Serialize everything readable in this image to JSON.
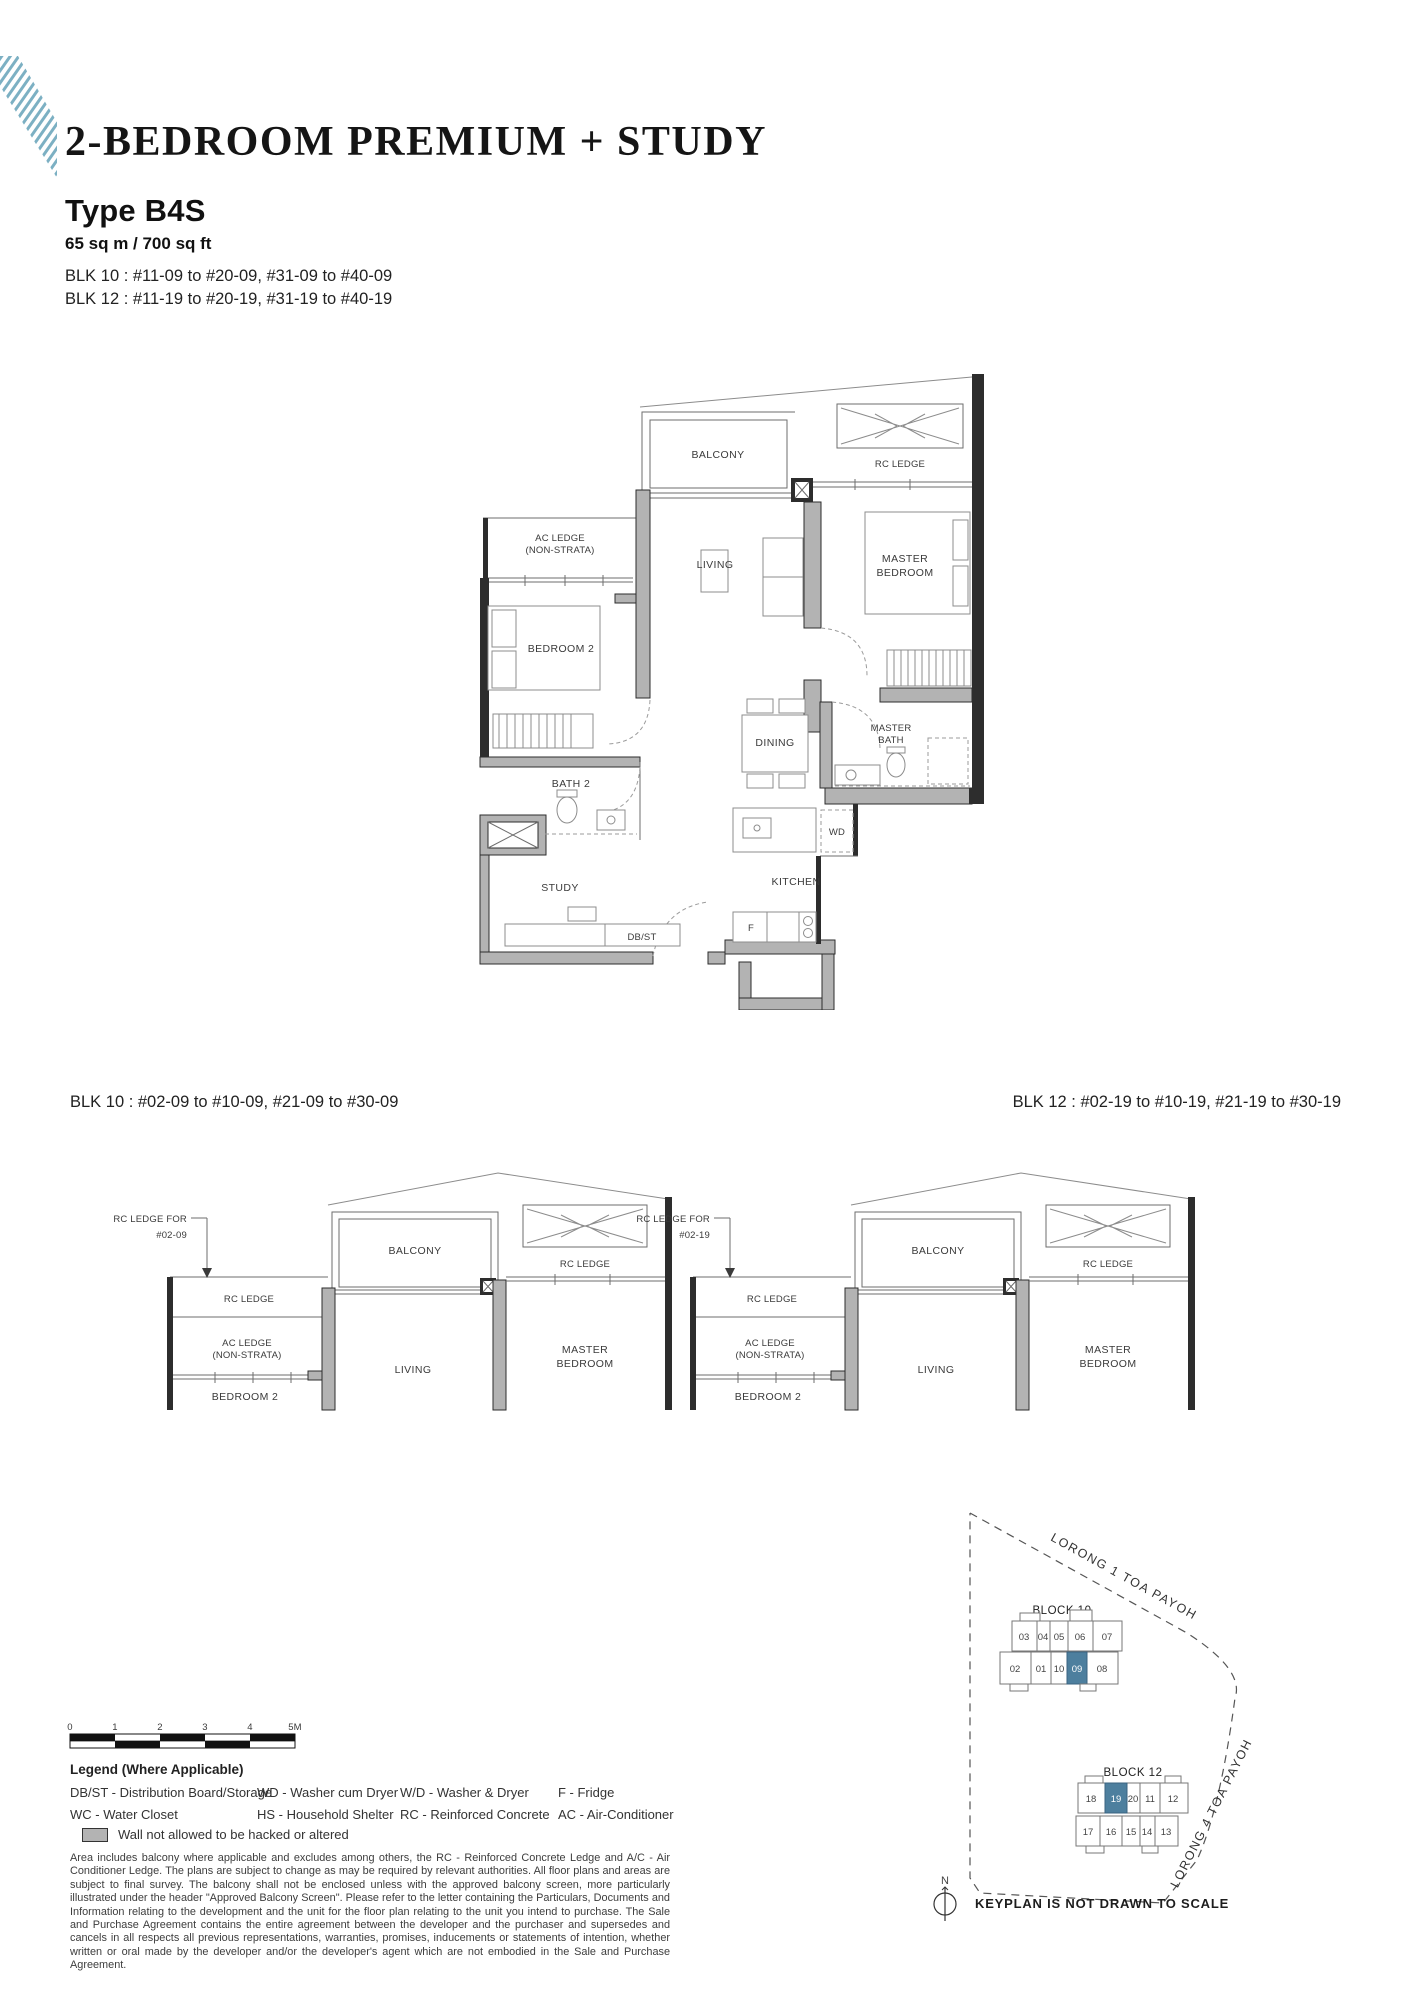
{
  "header": {
    "title": "2-BEDROOM PREMIUM + STUDY",
    "type_label": "Type B4S",
    "area": "65 sq m / 700 sq ft",
    "blk_line1": "BLK 10 : #11-09 to #20-09, #31-09 to #40-09",
    "blk_line2": "BLK 12 : #11-19 to #20-19, #31-19 to #40-19"
  },
  "main_plan": {
    "balcony": "BALCONY",
    "rc_ledge": "RC LEDGE",
    "ac_ledge_1": "AC LEDGE",
    "ac_ledge_2": "(NON-STRATA)",
    "living": "LIVING",
    "master_bedroom_1": "MASTER",
    "master_bedroom_2": "BEDROOM",
    "bedroom2": "BEDROOM 2",
    "dining": "DINING",
    "master_bath_1": "MASTER",
    "master_bath_2": "BATH",
    "bath2": "BATH 2",
    "wd": "WD",
    "study": "STUDY",
    "kitchen": "KITCHEN",
    "dbst": "DB/ST",
    "fridge": "F"
  },
  "partial_plans": {
    "left": {
      "caption": "BLK 10 : #02-09 to #10-09, #21-09 to #30-09",
      "rc_ledge_for_1": "RC LEDGE FOR",
      "rc_ledge_for_2": "#02-09",
      "rc_ledge": "RC LEDGE",
      "ac_ledge_1": "AC LEDGE",
      "ac_ledge_2": "(NON-STRATA)",
      "bedroom2": "BEDROOM 2",
      "balcony": "BALCONY",
      "living": "LIVING",
      "rc_ledge_right": "RC LEDGE",
      "master_bedroom_1": "MASTER",
      "master_bedroom_2": "BEDROOM"
    },
    "right": {
      "caption": "BLK 12 : #02-19 to #10-19, #21-19 to #30-19",
      "rc_ledge_for_1": "RC LEDGE FOR",
      "rc_ledge_for_2": "#02-19",
      "rc_ledge": "RC LEDGE",
      "ac_ledge_1": "AC LEDGE",
      "ac_ledge_2": "(NON-STRATA)",
      "bedroom2": "BEDROOM 2",
      "balcony": "BALCONY",
      "living": "LIVING",
      "rc_ledge_right": "RC LEDGE",
      "master_bedroom_1": "MASTER",
      "master_bedroom_2": "BEDROOM"
    }
  },
  "scale_bar": {
    "ticks": [
      "0",
      "1",
      "2",
      "3",
      "4",
      "5M"
    ]
  },
  "legend": {
    "title": "Legend (Where Applicable)",
    "columns": [
      [
        "DB/ST - Distribution Board/Storage",
        "WC - Water Closet"
      ],
      [
        "WD - Washer cum Dryer",
        "HS - Household Shelter"
      ],
      [
        "W/D - Washer & Dryer",
        "RC - Reinforced Concrete"
      ],
      [
        "F - Fridge",
        "AC - Air-Conditioner"
      ]
    ],
    "wall_note": "Wall not allowed to be hacked or altered"
  },
  "disclaimer": "Area includes balcony where applicable and excludes among others, the RC - Reinforced Concrete Ledge and A/C - Air Conditioner Ledge. The plans are subject to change as may be required by relevant authorities. All floor plans and areas are subject to final survey. The balcony shall not be enclosed unless with the approved balcony screen, more particularly illustrated under the header \"Approved Balcony Screen\". Please refer to the letter containing the Particulars, Documents and Information relating to the development and the unit for the floor plan relating to the unit you intend to purchase. The Sale and Purchase Agreement contains the entire agreement between the developer and the purchaser and supersedes and cancels in all respects all previous representations, warranties, promises, inducements or statements of intention, whether written or oral made by the developer and/or the developer's agent which are not embodied in the Sale and Purchase Agreement.",
  "keyplan": {
    "block10": {
      "label": "BLOCK 10",
      "row1": [
        "03",
        "04",
        "05",
        "06",
        "07"
      ],
      "row2": [
        "02",
        "01",
        "10",
        "09",
        "08"
      ],
      "highlighted_unit": "09"
    },
    "block12": {
      "label": "BLOCK 12",
      "row1": [
        "18",
        "19",
        "20",
        "11",
        "12"
      ],
      "row2": [
        "17",
        "16",
        "15",
        "14",
        "13"
      ],
      "highlighted_unit": "19"
    },
    "road1": "LORONG 1 TOA PAYOH",
    "road2": "LORONG 4 TOA PAYOH",
    "north": "N",
    "note": "KEYPLAN IS NOT DRAWN TO SCALE"
  },
  "colors": {
    "accent_highlight": "#4d7f9e",
    "logo_teal": "#7cb0c3",
    "wall_gray": "#b3b3b3"
  }
}
